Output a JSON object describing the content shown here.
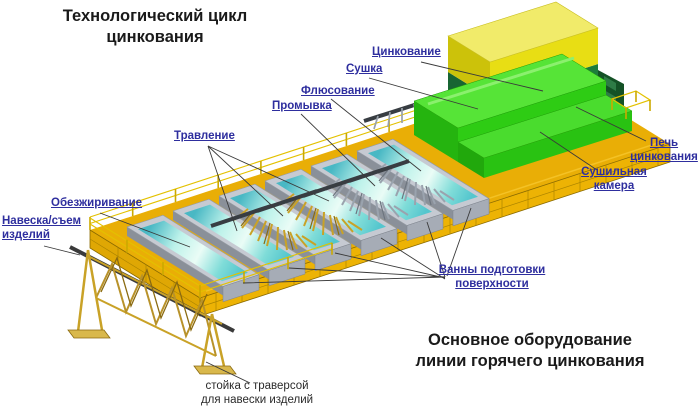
{
  "page": {
    "width": 700,
    "height": 410,
    "background": "#ffffff"
  },
  "titles": {
    "top": "Технологический цикл\nцинкования",
    "bottom": "Основное оборудование\nлинии горячего цинкования"
  },
  "process_labels": {
    "zinc": "Цинкование",
    "drying": "Сушка",
    "fluxing": "Флюсование",
    "rinsing": "Промывка",
    "pickling": "Травление",
    "degreasing": "Обезжиривание",
    "hanging": "Навеска/съем\nизделий"
  },
  "equipment_labels": {
    "furnace": "Печь\nцинкования",
    "drying_chamber": "Сушильная\nкамера",
    "prep_baths": "Ванны подготовки\nповерхности",
    "rack_caption": "стойка с траверсой\nдля навески изделий"
  },
  "colors": {
    "label_blue": "#2E2E9E",
    "title_black": "#1a1a1a",
    "platform_gold": "#E9AE06",
    "platform_wall_yellow": "#EDB304",
    "water_cyan": "#6FD4D8",
    "bath_rim_gray": "#C6CAD2",
    "chamber_green": "#2ECC14",
    "furnace_body_green": "#1E7C3C",
    "furnace_top_yellow": "#E6DC12",
    "articles_gold": "#C9A227"
  }
}
